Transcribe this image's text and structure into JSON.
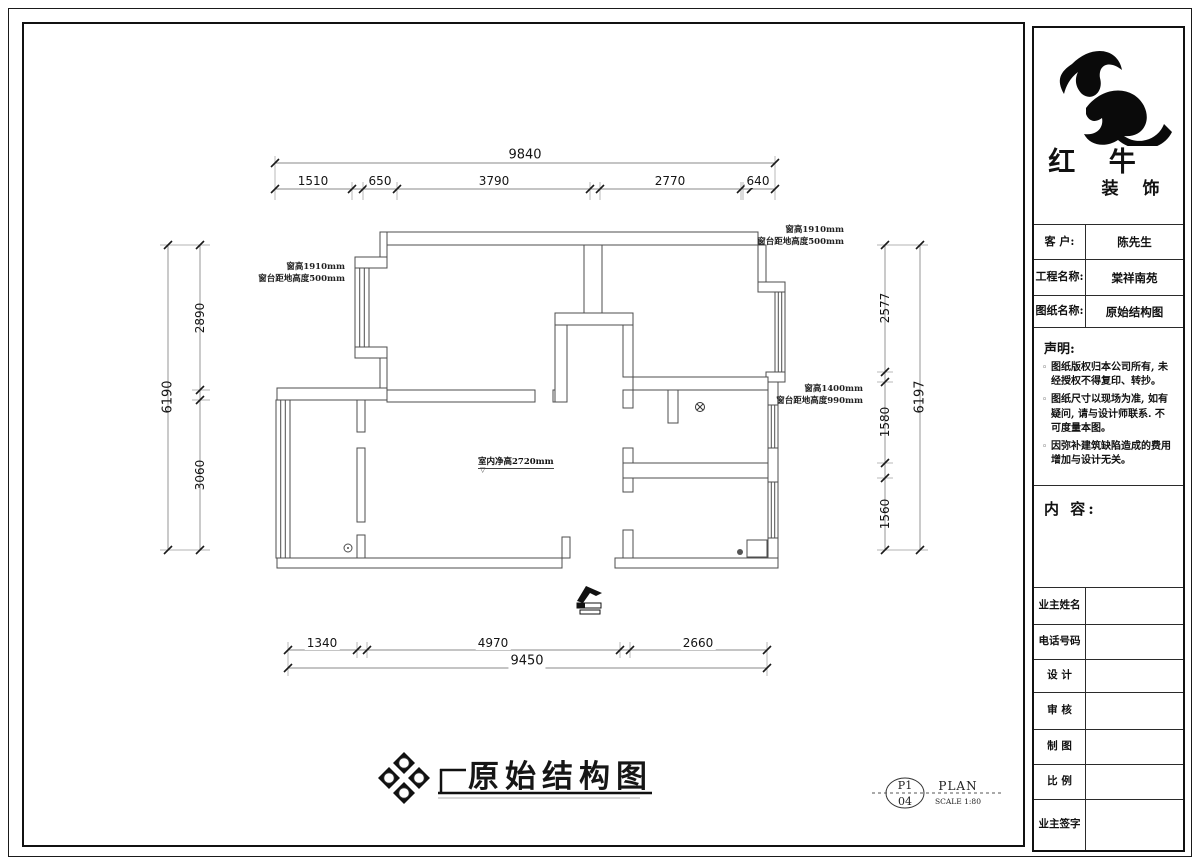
{
  "title_block": {
    "brand": {
      "line1": "红 牛",
      "line2": "装 饰"
    },
    "info_rows": [
      {
        "label": "客  户:",
        "value": "陈先生"
      },
      {
        "label": "工程名称:",
        "value": "棠祥南苑"
      },
      {
        "label": "图纸名称:",
        "value": "原始结构图"
      }
    ],
    "statement": {
      "title": "声明:",
      "items": [
        "图纸版权归本公司所有, 未经授权不得复印、转抄。",
        "图纸尺寸以现场为准, 如有疑问, 请与设计师联系. 不可度量本图。",
        "因弥补建筑缺陷造成的费用增加与设计无关。"
      ]
    },
    "content_label": "内 容:",
    "sign_rows": [
      {
        "label": "业主姓名"
      },
      {
        "label": "电话号码"
      },
      {
        "label": "设 计"
      },
      {
        "label": "审 核"
      },
      {
        "label": "制 图"
      },
      {
        "label": "比 例"
      },
      {
        "label": "业主签字"
      }
    ]
  },
  "plan": {
    "title": "原始结构图",
    "dimensions": {
      "top_total": "9840",
      "top_segments": [
        "1510",
        "650",
        "3790",
        "2770",
        "640"
      ],
      "left_total": "6190",
      "left_segments": [
        "2890",
        "3060"
      ],
      "right_total": "6197",
      "right_segments": [
        "2577",
        "1580",
        "1560"
      ],
      "bottom_total": "9450",
      "bottom_segments": [
        "1340",
        "4970",
        "2660"
      ]
    },
    "annotations": {
      "window_left_line1": "窗高1910mm",
      "window_left_line2": "窗台距地高度500mm",
      "window_top_right_line1": "窗高1910mm",
      "window_top_right_line2": "窗台距地高度500mm",
      "window_mid_right_line1": "窗高1400mm",
      "window_mid_right_line2": "窗台距地高度990mm",
      "ceiling_height": "室内净高2720mm",
      "ceiling_marker": "▽"
    },
    "compass_letters": [
      "A",
      "B",
      "C",
      "D"
    ],
    "sheet": {
      "code": "P1",
      "number": "04",
      "type": "PLAN",
      "scale": "SCALE 1:80"
    }
  }
}
